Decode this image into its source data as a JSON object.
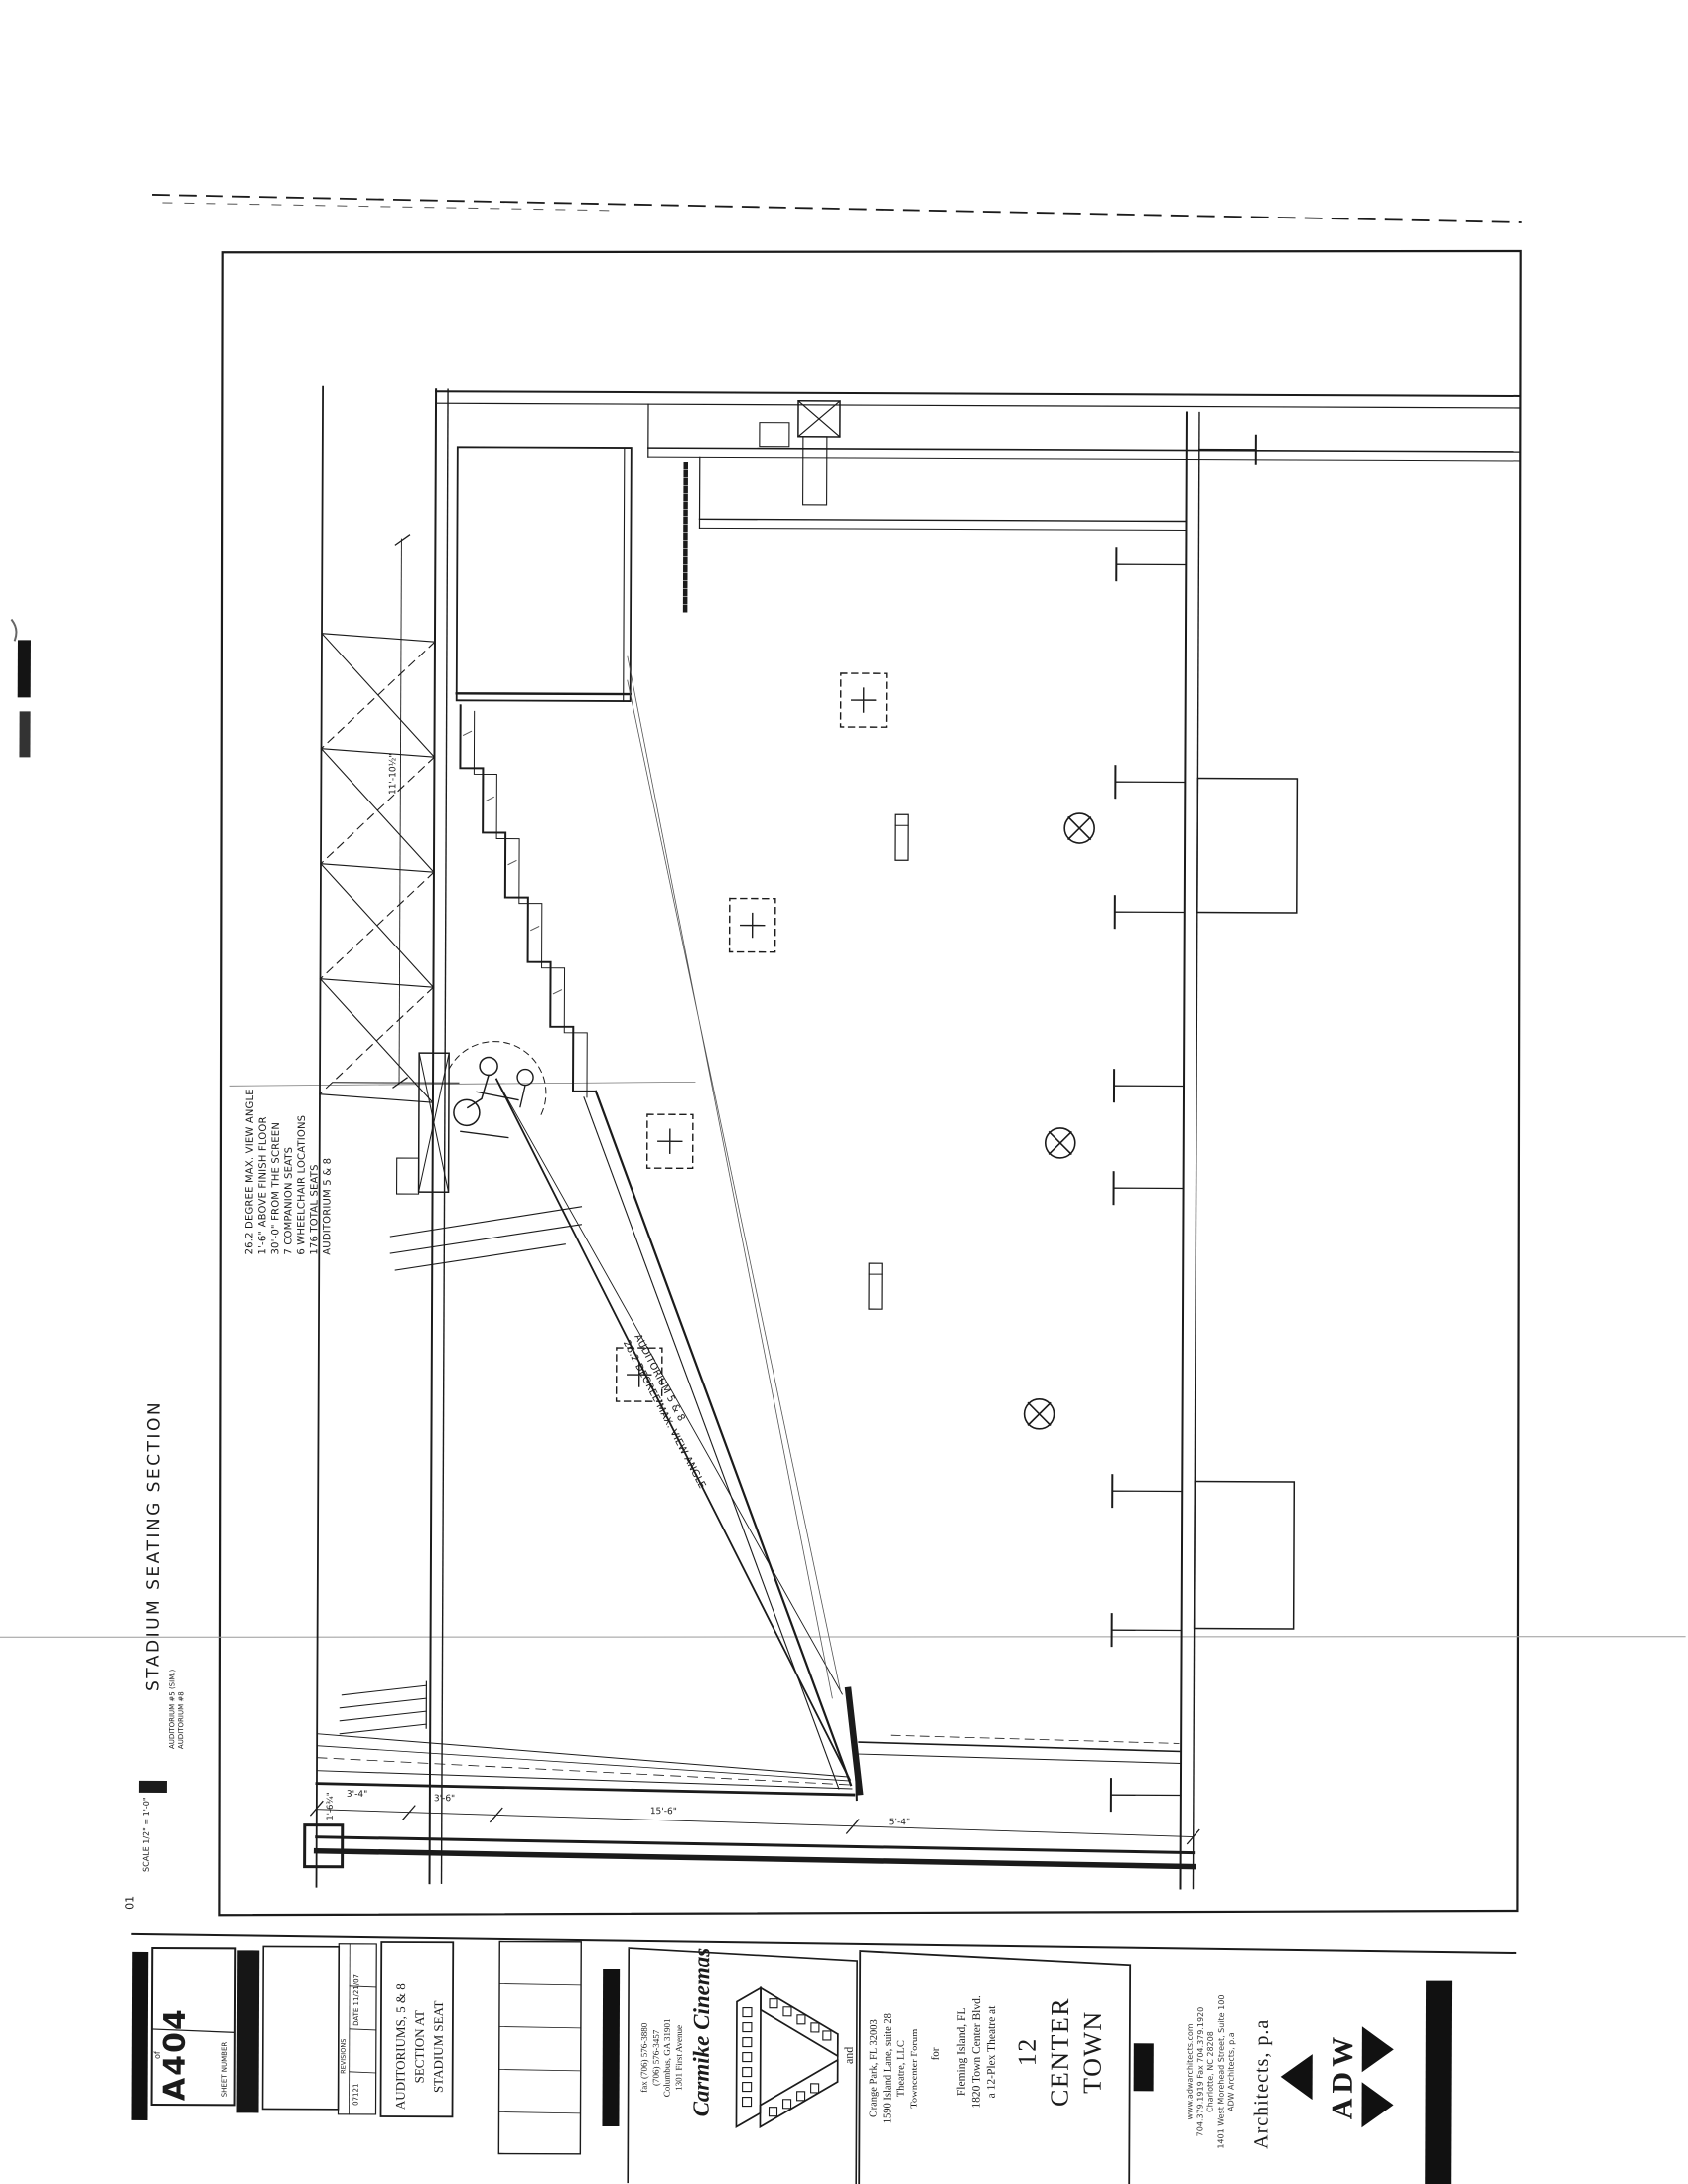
{
  "sheet": {
    "drawing_title": "STADIUM SEATING SECTION",
    "drawing_subtitle_lines": [
      "AUDITORIUM #8",
      "AUDITORIUM #5 (SIM.)"
    ],
    "scale_note": "SCALE 1/2\" = 1'-0\"",
    "detail_number": "01"
  },
  "notes": {
    "lines": [
      "AUDITORIUM 5 & 8",
      "176 TOTAL SEATS",
      "6 WHEELCHAIR LOCATIONS",
      "7 COMPANION SEATS",
      "30'-0\" FROM THE SCREEN",
      "1'-6\" ABOVE FINISH FLOOR",
      "26.2 DEGREE MAX. VIEW ANGLE"
    ]
  },
  "sightline_label": {
    "lines": [
      "AUDITORIUM 5 & 8",
      "26.2 DEGREE MAX. VIEW ANGLE"
    ]
  },
  "dimensions": {
    "stair_run": "11'-10½\"",
    "riser_offset": "1'-6¾\"",
    "d1": "3'-4\"",
    "d2": "3'-6\"",
    "d3": "15'-6\"",
    "d4": "5'-4\""
  },
  "title_block": {
    "sheet_number_label": "SHEET NUMBER",
    "sheet_number": "A404",
    "of_label": "of",
    "date": "DATE 11/21/07",
    "revisions_label": "REVISIONS",
    "job_number": "07121",
    "sheet_title_lines": [
      "STADIUM SEAT",
      "SECTION AT",
      "AUDITORIUMS, 5 & 8"
    ],
    "client": {
      "name": "Carmike Cinemas",
      "address_lines": [
        "1301 First Avenue",
        "Columbus, GA 31901",
        "(706) 576-3457",
        "fax (706) 576-3880"
      ],
      "joiner": "and"
    },
    "project": {
      "name_lines": [
        "TOWN",
        "CENTER",
        "12"
      ],
      "description_lines": [
        "a 12-Plex Theatre at",
        "1820 Town Center Blvd.",
        "Fleming Island, FL"
      ],
      "for_label": "for",
      "owner_lines": [
        "Towncenter Forum",
        "Theatre, LLC",
        "1590 Island Lane, suite 28",
        "Orange Park, FL 32003"
      ]
    },
    "architect": {
      "logo_text": "ADW",
      "name": "Architects, p.a",
      "info_lines": [
        "ADW Architects, p.a",
        "1401 West Morehead Street, Suite 100",
        "Charlotte, NC 28208",
        "704.379.1919  Fax 704.379.1920",
        "www.adwarchitects.com"
      ]
    }
  },
  "colors": {
    "ink": "#1b1b1b",
    "paper": "#ffffff",
    "faint_line": "#999999"
  }
}
